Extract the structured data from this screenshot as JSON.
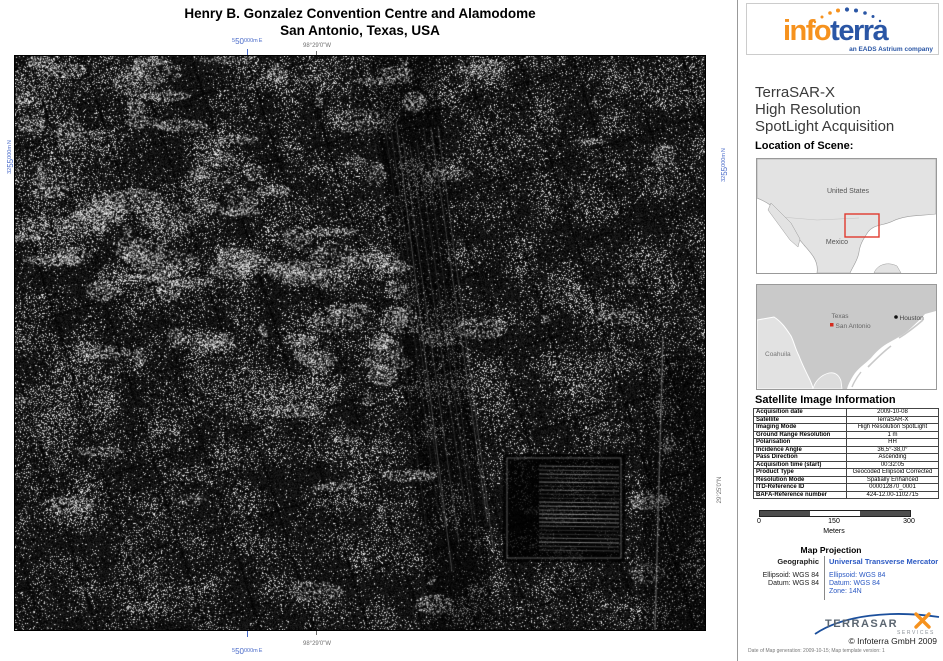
{
  "page_title": {
    "line1": "Henry B. Gonzalez Convention Centre and Alamodome",
    "line2": "San Antonio, Texas, USA"
  },
  "map": {
    "grid_labels": {
      "easting_prefix": "5",
      "easting_main": "50",
      "easting_suffix": "000m",
      "easting_dir": "E",
      "northing_prefix": "32",
      "northing_main": "55",
      "northing_suffix": "000m",
      "northing_dir": "N",
      "longitude": "98°29'0\"W",
      "latitude": "29°25'0\"N"
    }
  },
  "sidebar": {
    "logo": {
      "word_part1": "info",
      "word_part2": "terra",
      "tagline": "an EADS Astrium company"
    },
    "product_title": {
      "line1": "TerraSAR-X",
      "line2": "High Resolution",
      "line3": "SpotLight Acquisition"
    },
    "location_heading": "Location of Scene:",
    "overview_map": {
      "united_states": "United States",
      "mexico": "Mexico"
    },
    "detail_map": {
      "texas": "Texas",
      "san_antonio": "San Antonio",
      "houston": "Houston",
      "coahuila": "Coahuila"
    },
    "sat_info_heading": "Satellite Image Information",
    "sat_info_rows": [
      {
        "label": "Acquisition date",
        "value": "2009-10-08"
      },
      {
        "label": "Satellite",
        "value": "TerraSAR-X"
      },
      {
        "label": "Imaging Mode",
        "value": "High Resolution SpotLight"
      },
      {
        "label": "Ground Range Resolution",
        "value": "1 m"
      },
      {
        "label": "Polarisation",
        "value": "HH"
      },
      {
        "label": "Incidence Angle",
        "value": "36,5°-38,0°"
      },
      {
        "label": "Pass Direction",
        "value": "Ascending"
      },
      {
        "label": "Acquisition time (start)",
        "value": "00:32:05"
      },
      {
        "label": "Product Type",
        "value": "Geocoded Ellipsoid Corrected"
      },
      {
        "label": "Resolution Mode",
        "value": "Spatially Enhanced"
      },
      {
        "label": "ITD-Reference ID",
        "value": "000012870_0001"
      },
      {
        "label": "BAFA-Reference number",
        "value": "424-12.00-1102715"
      }
    ],
    "scale_bar": {
      "start": "0",
      "middle": "150",
      "end": "300",
      "unit": "Meters"
    },
    "projection": {
      "heading": "Map Projection",
      "geographic_heading": "Geographic",
      "geographic_lines": {
        "ellipsoid": "Ellipsoid: WGS 84",
        "datum": "Datum: WGS 84"
      },
      "utm_heading": "Universal Transverse Mercator",
      "utm_lines": {
        "ellipsoid": "Ellipsoid: WGS 84",
        "datum": "Datum: WGS 84",
        "zone": "Zone: 14N"
      }
    },
    "tsx_logo": {
      "name": "TERRASAR",
      "x": "X",
      "services": "SERVICES"
    },
    "copyright": "© Infoterra GmbH 2009",
    "generation_note": "Date of Map generation: 2009-10-15; Map template version: 1"
  },
  "colors": {
    "grid_label_blue": "#4a6bc9",
    "geo_label_grey": "#707070",
    "utm_text_blue": "#2b59c3",
    "infoterra_orange": "#f6921e",
    "infoterra_blue": "#2a56a5",
    "scene_box_red": "#e03a2f",
    "scalebar_dark": "#4d4d4d"
  }
}
